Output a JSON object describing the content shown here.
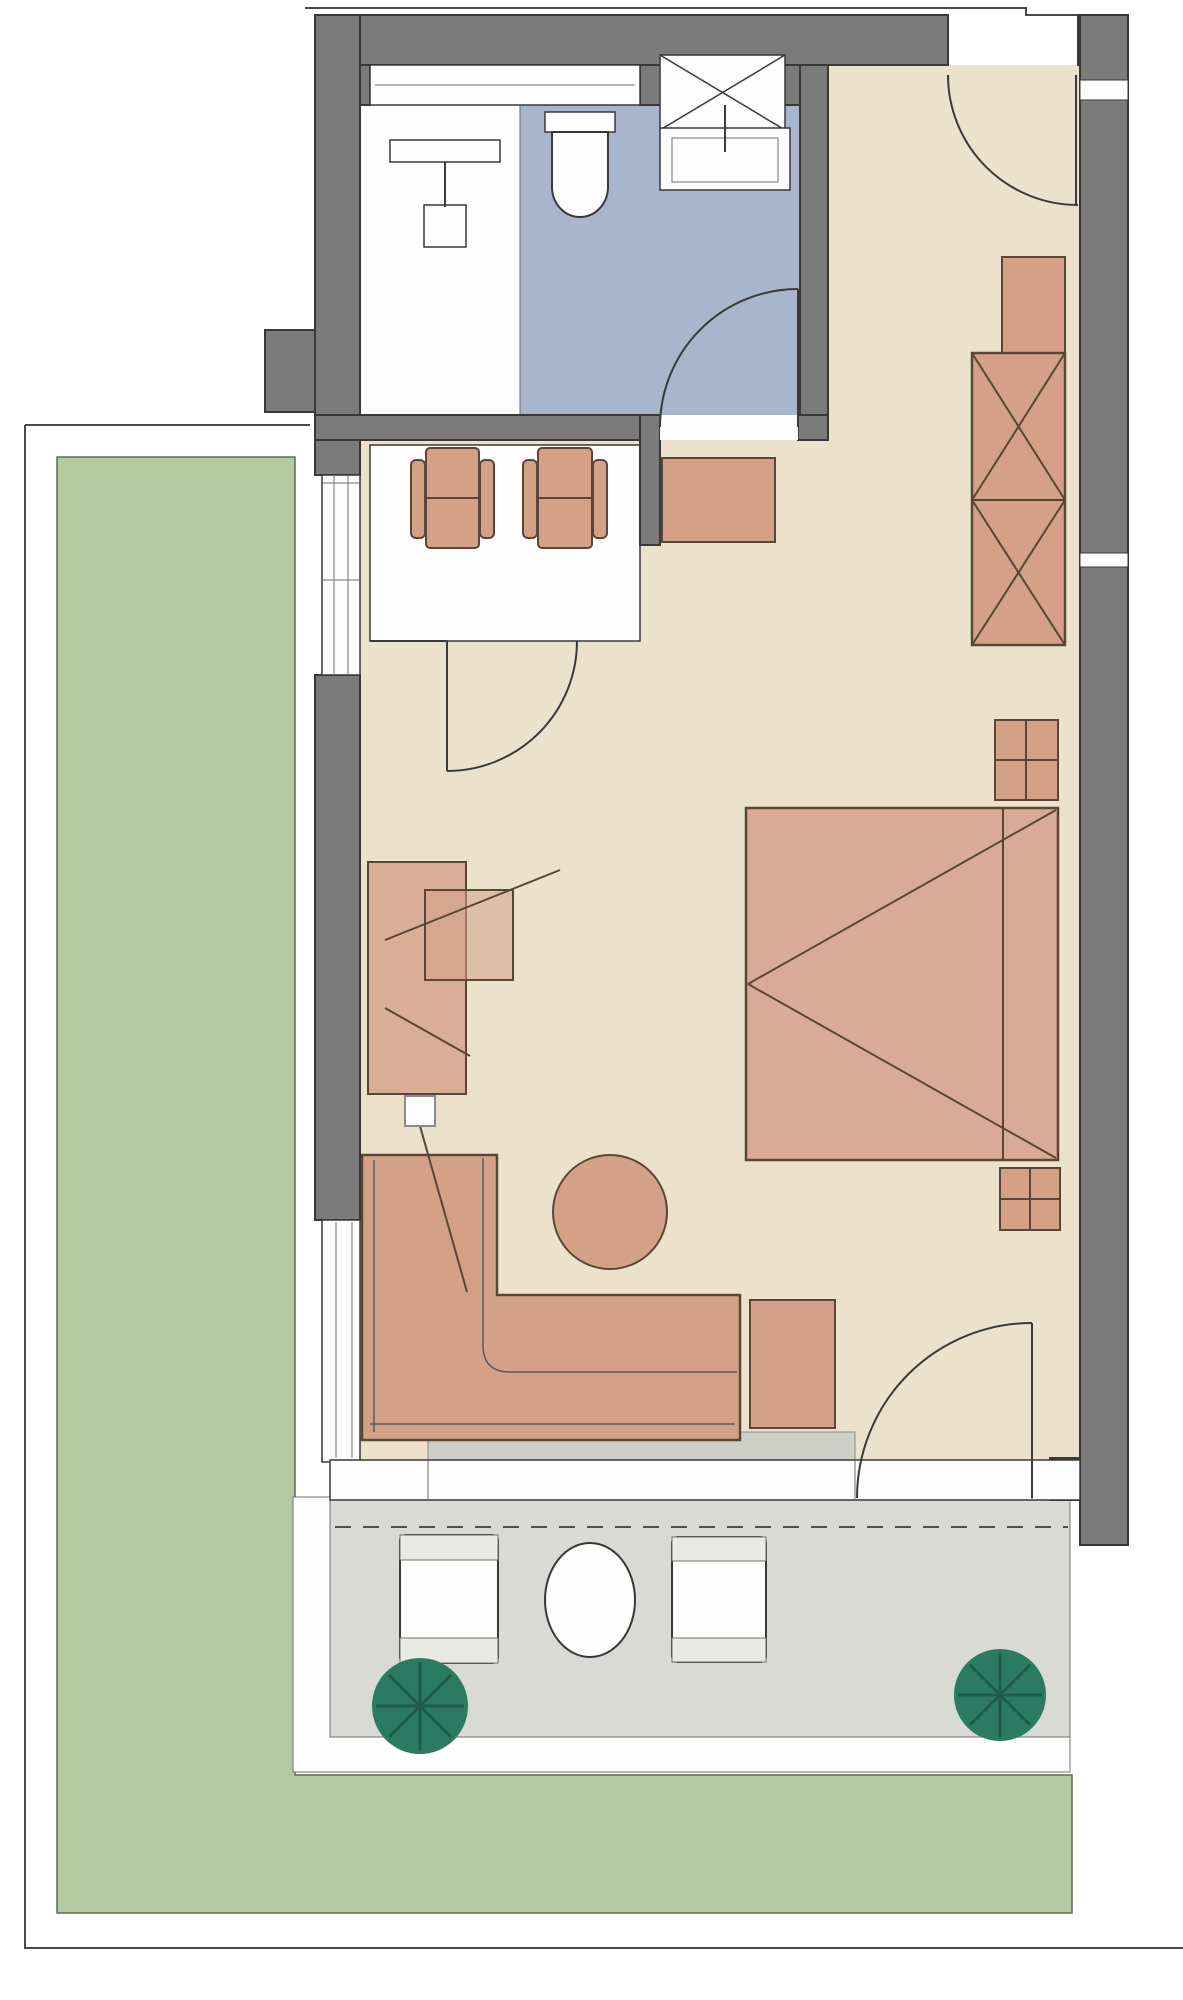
{
  "palette": {
    "background": "#ffffff",
    "wall": "#7b7b7b",
    "wall_dark": "#505050",
    "floor_main": "#ece2cc",
    "floor_bath": "#a9b5cd",
    "fixture_white": "#fdfdfd",
    "furniture": "#d4a188",
    "bed": "#d9ab96",
    "garden": "#b4cba2",
    "terrace": "#d9d9d5",
    "terrace_edge": "#fdfdfd",
    "mat": "#cfcfca",
    "plant": "#2b7a62",
    "chair_band": "#e9e9e5"
  },
  "plan": {
    "rooms": [
      "bathroom",
      "main-room",
      "terrace",
      "garden"
    ],
    "furniture": [
      "shower",
      "toilet",
      "sink",
      "vent-shaft",
      "dining-table",
      "dining-chair",
      "dining-chair",
      "entry-cabinet",
      "tall-cabinet",
      "wardrobe",
      "nightstand",
      "double-bed",
      "nightstand",
      "desk",
      "desk-chair",
      "corner-sofa",
      "ottoman",
      "round-coffee-table",
      "terrace-chair",
      "terrace-table",
      "terrace-chair",
      "plant",
      "plant"
    ],
    "doors": [
      "entrance-door",
      "bathroom-door",
      "interior-door",
      "terrace-door"
    ]
  }
}
